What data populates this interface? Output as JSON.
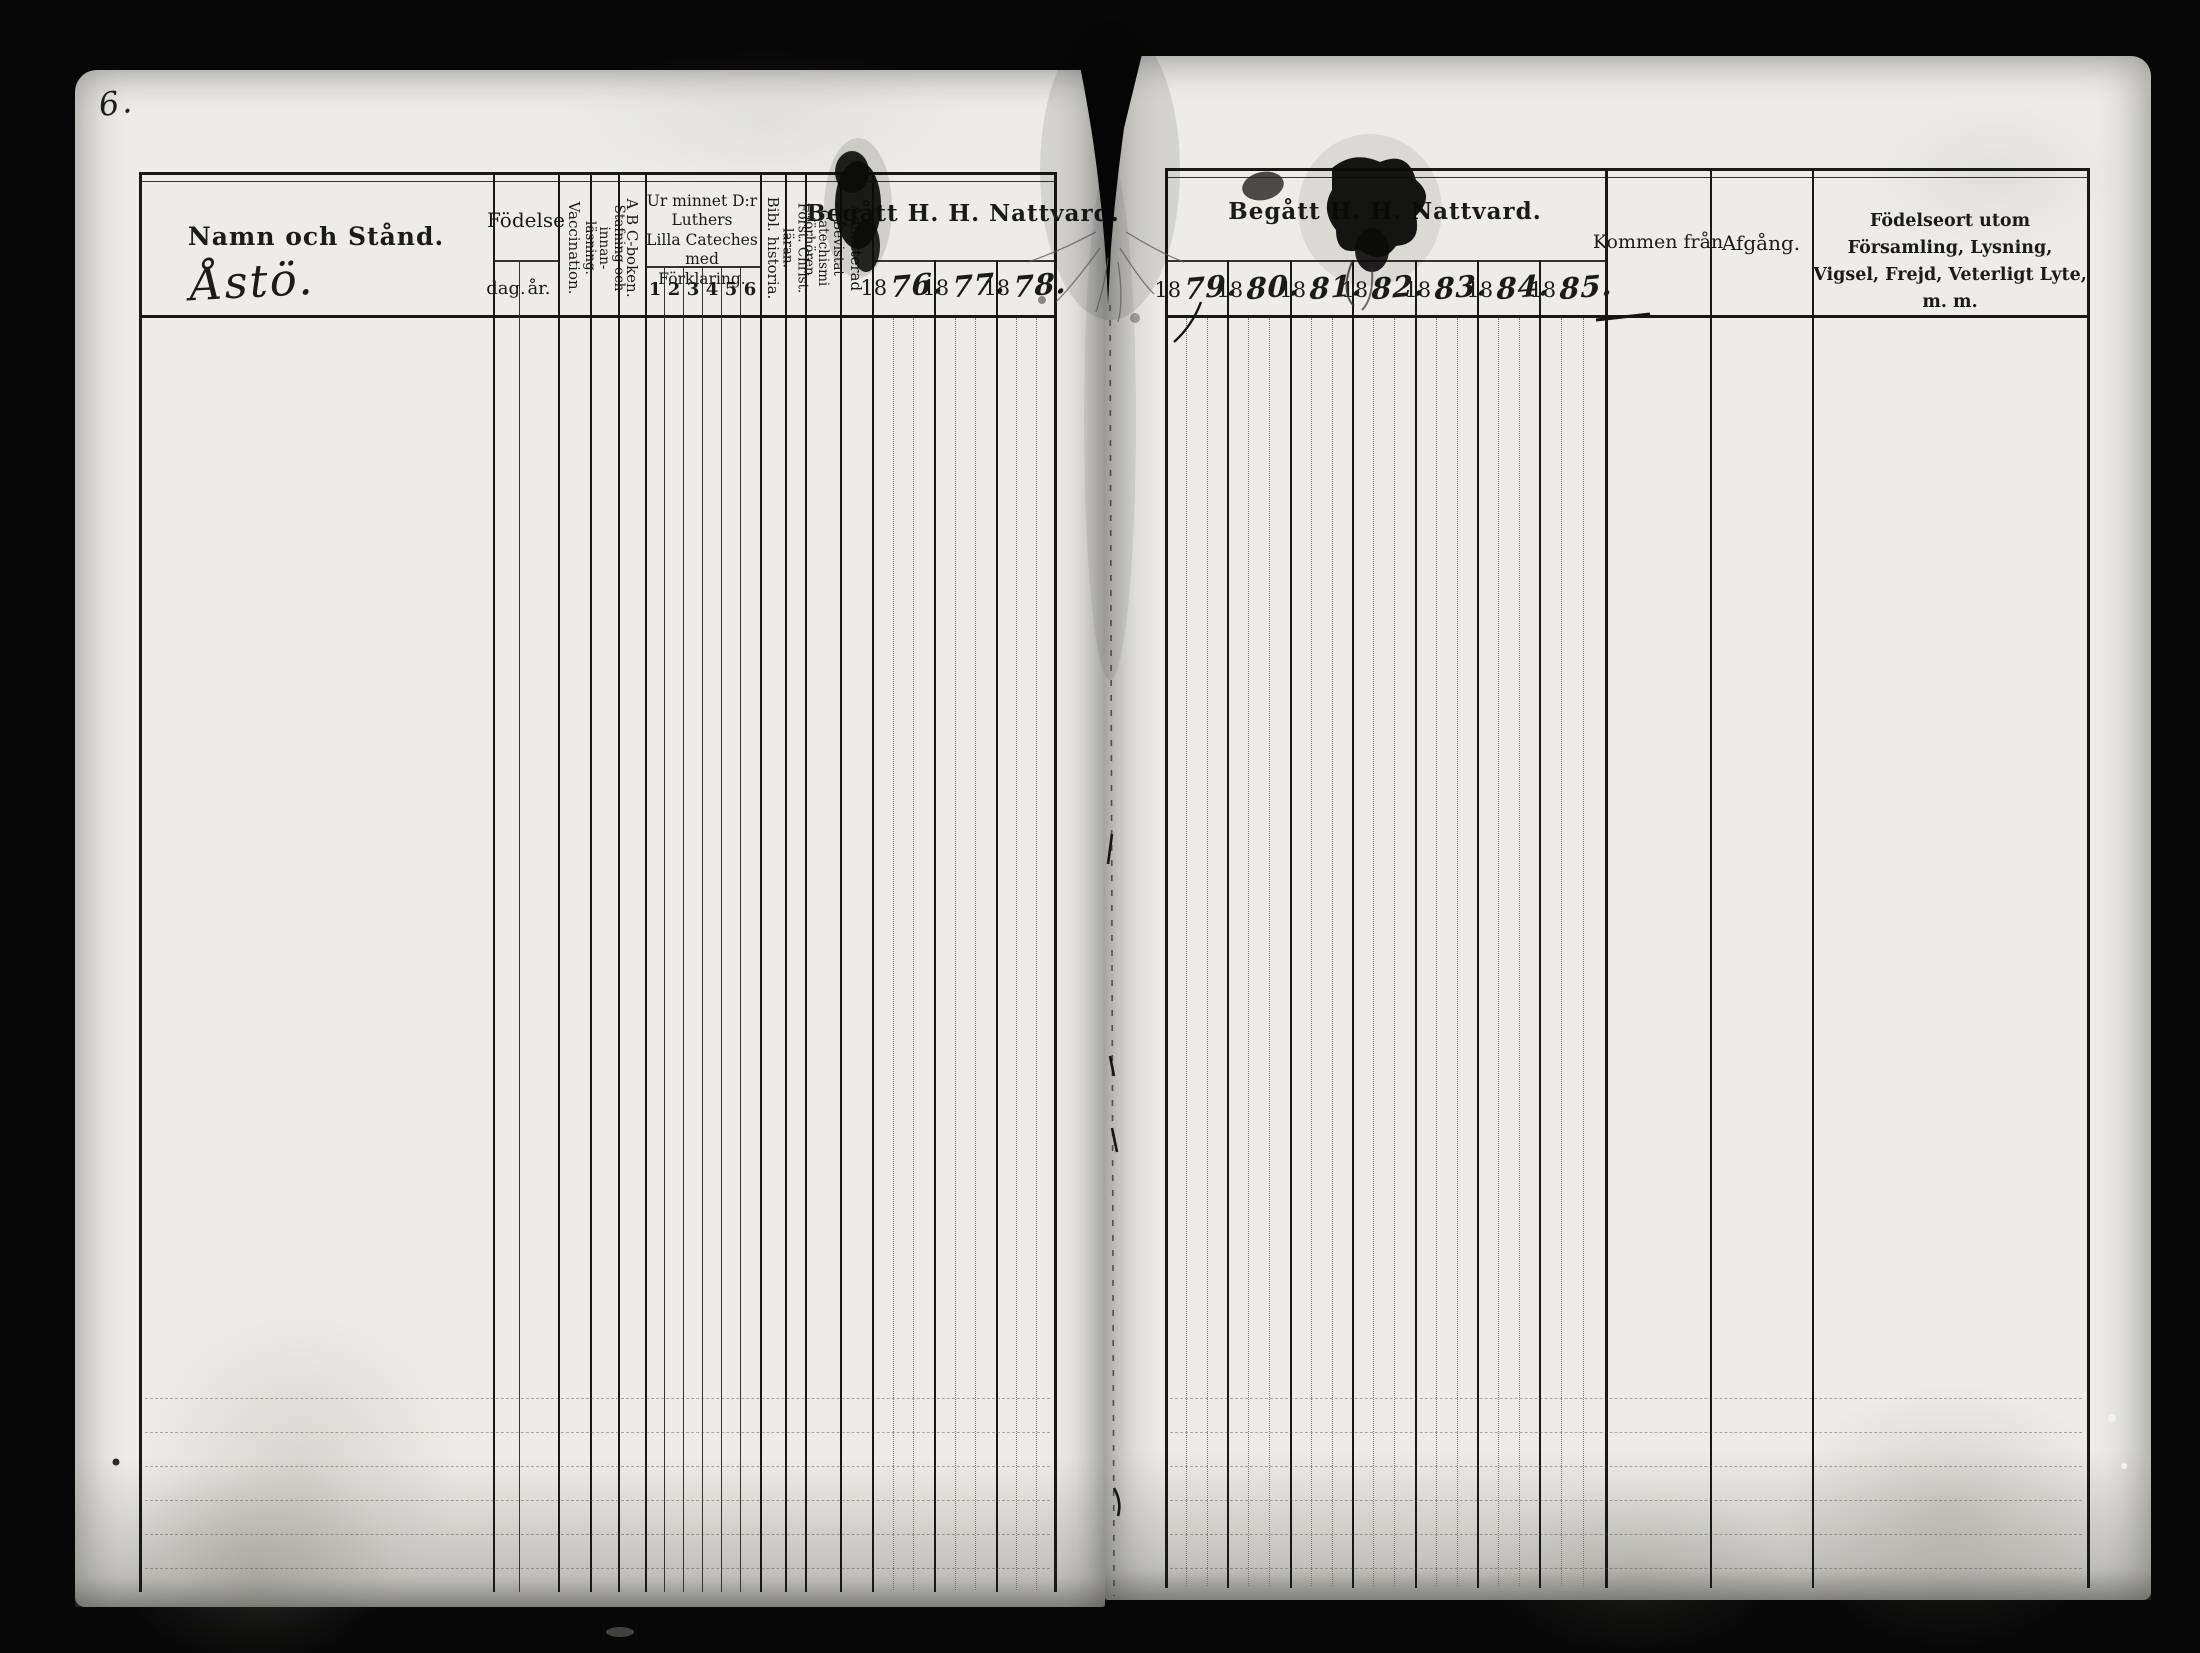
{
  "folio": "6.",
  "left_table": {
    "namn": {
      "label": "Namn och Stånd.",
      "entry": "Åstö."
    },
    "fodelse": {
      "label": "Födelse",
      "dag": "dag.",
      "ar": "år."
    },
    "vaccination": {
      "label": "Vaccination."
    },
    "stafning": {
      "line1": "Stafning och innan-",
      "line2": "läsning."
    },
    "abc": {
      "label": "A B C-boken."
    },
    "urminnet": {
      "line1": "Ur minnet D:r Luthers",
      "line2": "Lilla Cateches med",
      "line3": "Förklaring.",
      "cols": [
        "1",
        "2",
        "3",
        "4",
        "5",
        "6"
      ]
    },
    "bibl": {
      "label": "Bibl. historia."
    },
    "forst": {
      "label": "Först. Christ. läran."
    },
    "bevistat": {
      "line1": "Bevistat Catechismi",
      "line2": "förhören."
    },
    "admitterad": {
      "label": "Admitterad"
    },
    "nattvard": {
      "label": "Begått H. H. Nattvard.",
      "years": [
        {
          "printed": "18",
          "hand": "76."
        },
        {
          "printed": "18",
          "hand": "77."
        },
        {
          "printed": "18",
          "hand": "78."
        }
      ]
    }
  },
  "right_table": {
    "nattvard": {
      "label": "Begått H. H. Nattvard.",
      "years": [
        {
          "printed": "18",
          "hand": "79."
        },
        {
          "printed": "18",
          "hand": "80."
        },
        {
          "printed": "18",
          "hand": "81."
        },
        {
          "printed": "18",
          "hand": "82."
        },
        {
          "printed": "18",
          "hand": "83."
        },
        {
          "printed": "18",
          "hand": "84."
        },
        {
          "printed": "18",
          "hand": "85."
        }
      ]
    },
    "kommen": {
      "label": "Kommen från"
    },
    "afgang": {
      "label": "Afgång."
    },
    "fodelseort": {
      "line1": "Födelseort utom Församling, Lysning,",
      "line2": "Vigsel, Frejd, Veterligt Lyte, m. m."
    }
  }
}
